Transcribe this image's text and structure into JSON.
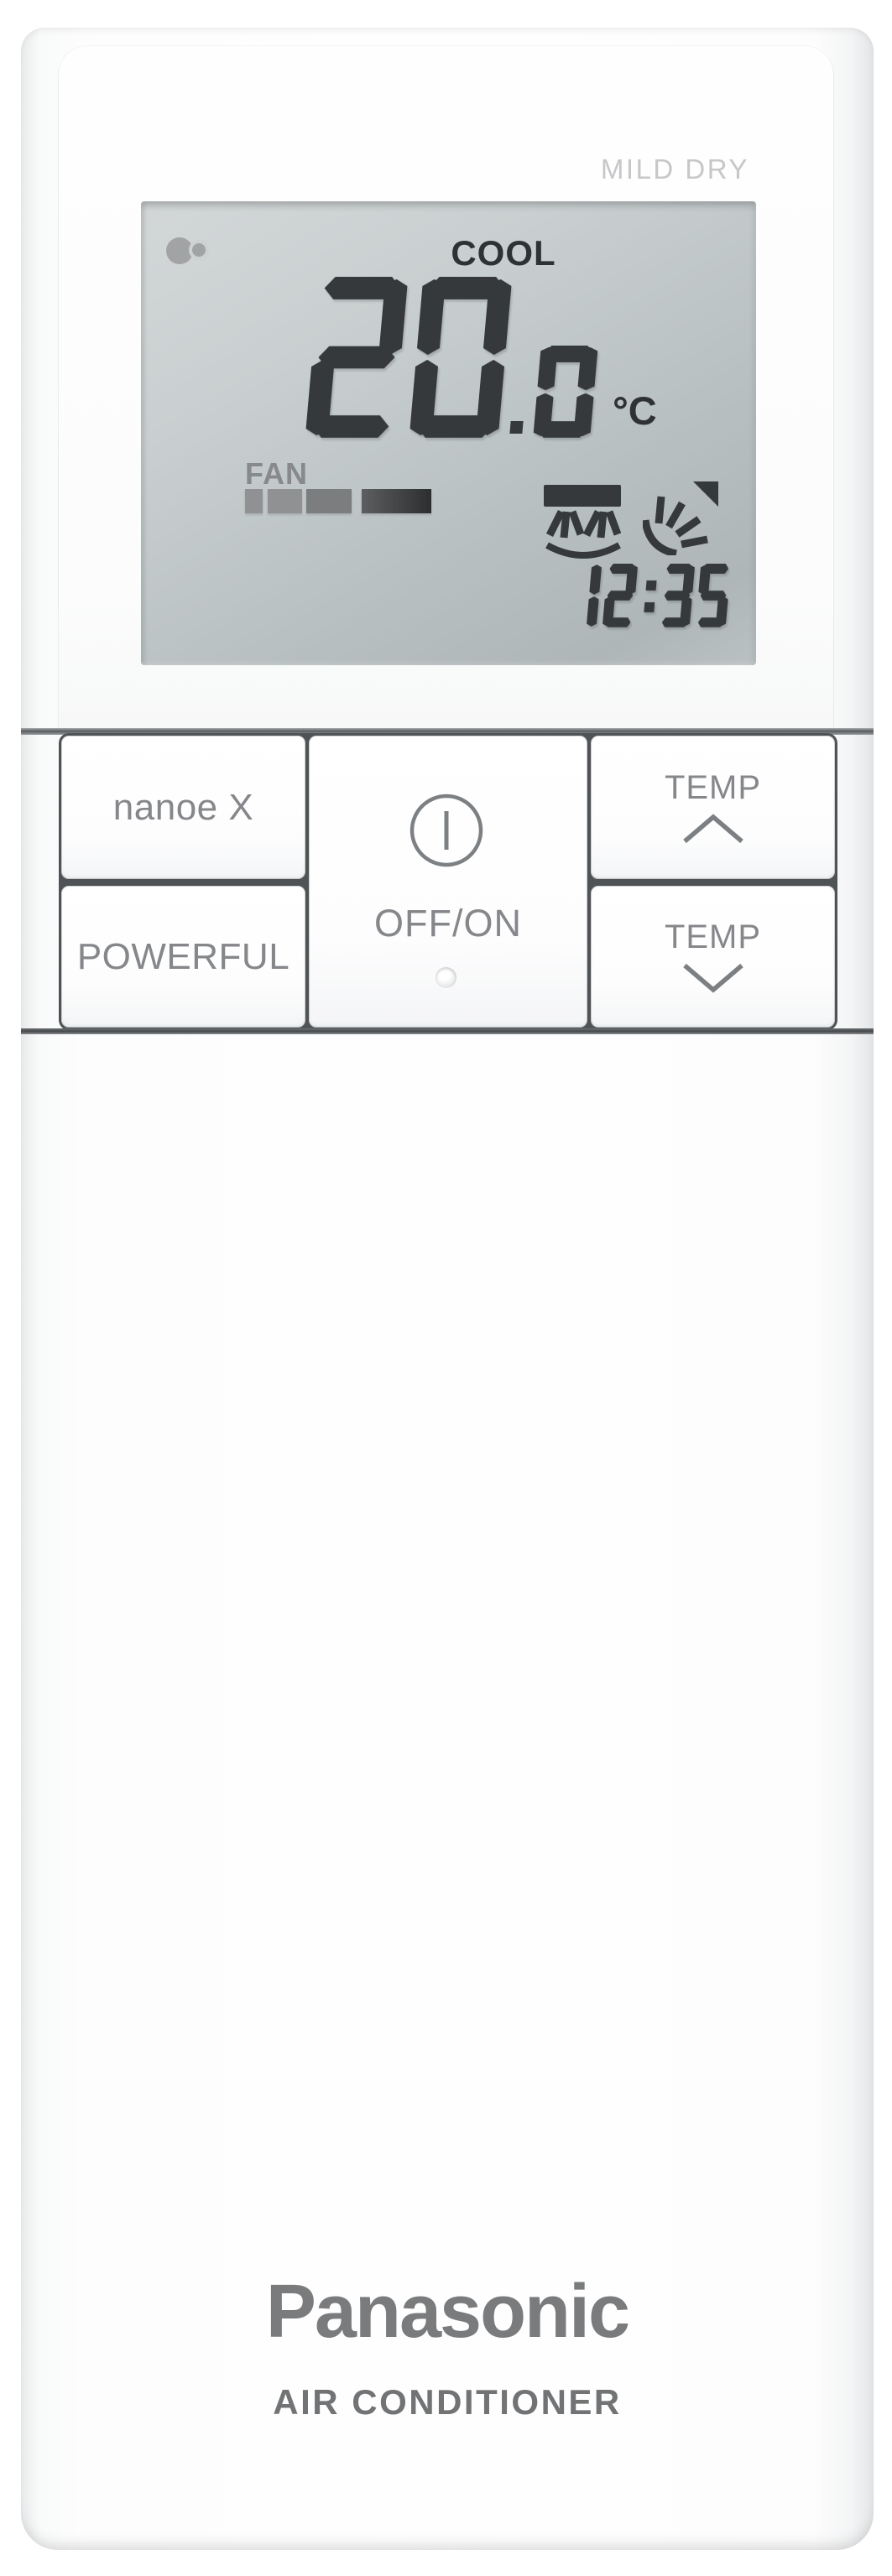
{
  "lcd": {
    "mild_dry_label": "MILD DRY",
    "mode": "COOL",
    "temperature": {
      "integer": "20",
      "decimal": "0",
      "unit": "°C"
    },
    "fan": {
      "label": "FAN",
      "bars": [
        {
          "width": 21,
          "shade": "light"
        },
        {
          "width": 41,
          "shade": "light"
        },
        {
          "width": 54,
          "shade": "medium"
        },
        {
          "width": 83,
          "shade": "dark"
        }
      ]
    },
    "time": "12:35",
    "indicators": {
      "nanoe": "nanoe-indicator",
      "swing_vertical": "air-swing-up-down",
      "swing_horizontal": "air-swing-left-right"
    }
  },
  "buttons": {
    "nanoe_x": {
      "label": "nanoe X"
    },
    "powerful": {
      "label": "POWERFUL"
    },
    "power": {
      "label": "OFF/ON",
      "icon": "power-icon"
    },
    "temp_up": {
      "label": "TEMP",
      "direction": "up"
    },
    "temp_down": {
      "label": "TEMP",
      "direction": "down"
    }
  },
  "branding": {
    "logo": "Panasonic",
    "subtitle": "AIR CONDITIONER"
  },
  "colors": {
    "lcd_segment": "#35393c",
    "lcd_background": "#c3c9cb",
    "button_text": "#85878a",
    "logo_gray": "#7a7b7d"
  }
}
